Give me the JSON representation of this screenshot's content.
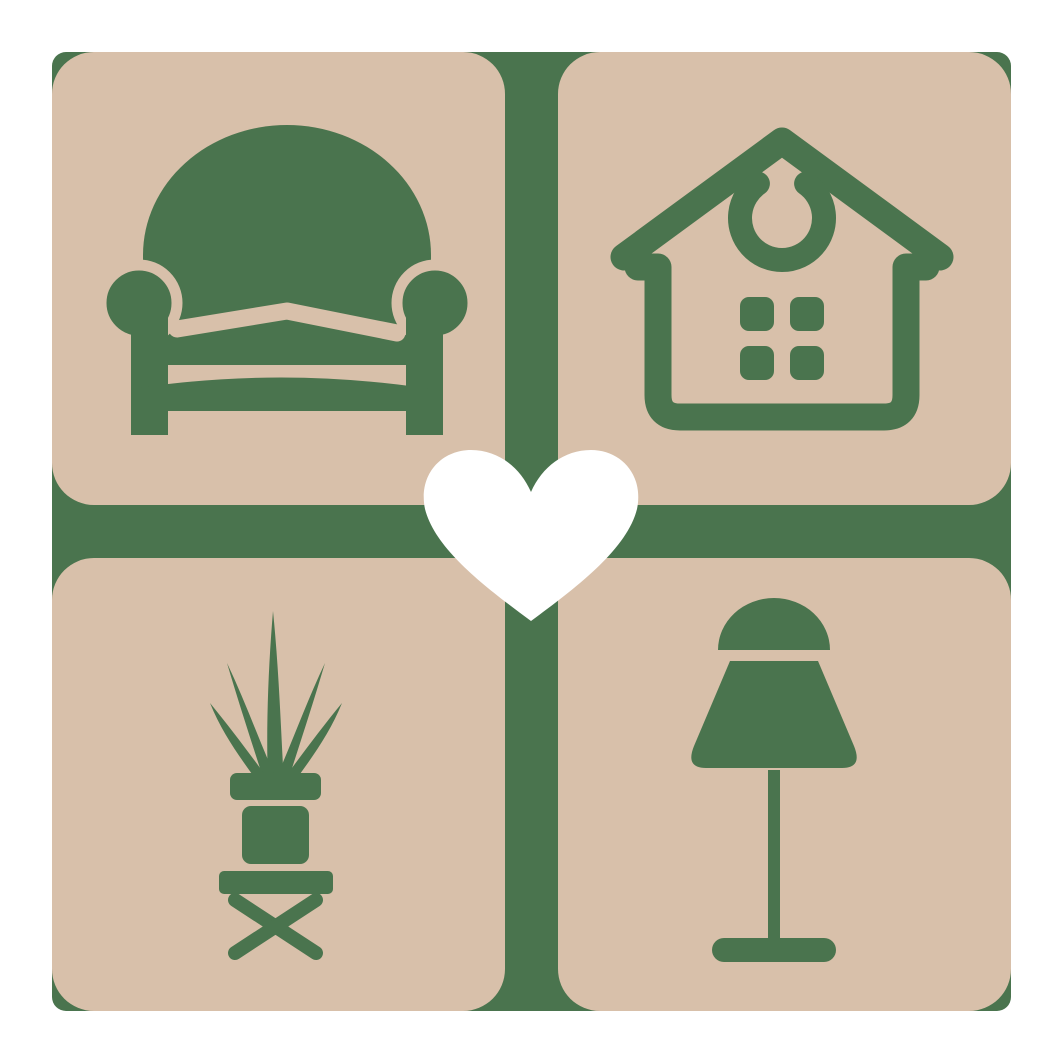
{
  "logo": {
    "name": "home-decor-heart-logo",
    "description": "Four tan rounded tiles on a green backplate cross with a white heart in the center",
    "tiles": [
      {
        "icon": "armchair-icon",
        "label": "Armchair"
      },
      {
        "icon": "house-icon",
        "label": "House"
      },
      {
        "icon": "potted-plant-icon",
        "label": "Potted plant on stool"
      },
      {
        "icon": "table-lamp-icon",
        "label": "Table lamp"
      }
    ],
    "center": {
      "icon": "heart-icon",
      "label": "Heart"
    }
  },
  "colors": {
    "green": "#4A744E",
    "tan": "#D8C0AA",
    "heart-white": "#FFFFFF",
    "background": "#FFFFFF"
  }
}
